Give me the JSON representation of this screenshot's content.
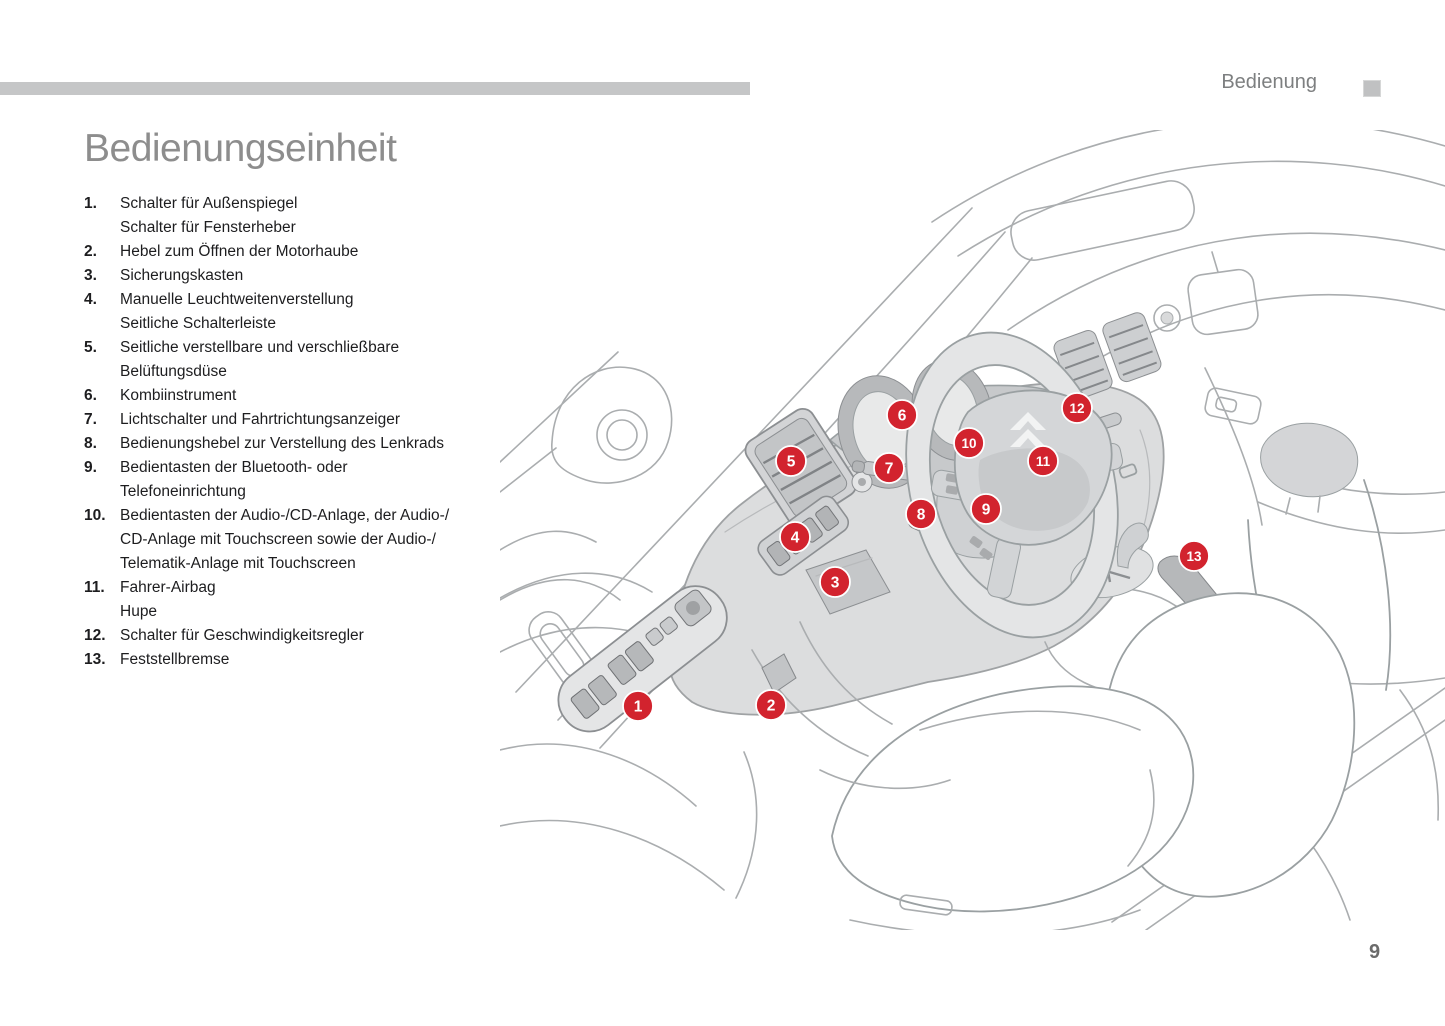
{
  "header": {
    "section_label": "Bedienung"
  },
  "title": "Bedienungseinheit",
  "footer": {
    "page_number": "9"
  },
  "legend": [
    {
      "num": "1.",
      "lines": [
        "Schalter für Außenspiegel",
        "Schalter für Fensterheber"
      ]
    },
    {
      "num": "2.",
      "lines": [
        "Hebel zum Öffnen der Motorhaube"
      ]
    },
    {
      "num": "3.",
      "lines": [
        "Sicherungskasten"
      ]
    },
    {
      "num": "4.",
      "lines": [
        "Manuelle Leuchtweitenverstellung",
        "Seitliche Schalterleiste"
      ]
    },
    {
      "num": "5.",
      "lines": [
        "Seitliche verstellbare und verschließbare",
        "Belüftungsdüse"
      ]
    },
    {
      "num": "6.",
      "lines": [
        "Kombiinstrument"
      ]
    },
    {
      "num": "7.",
      "lines": [
        "Lichtschalter und Fahrtrichtungsanzeiger"
      ]
    },
    {
      "num": "8.",
      "lines": [
        "Bedienungshebel zur Verstellung des Lenkrads"
      ]
    },
    {
      "num": "9.",
      "lines": [
        "Bedientasten der Bluetooth- oder",
        "Telefoneinrichtung"
      ]
    },
    {
      "num": "10.",
      "lines": [
        "Bedientasten der Audio-/CD-Anlage, der Audio-/",
        "CD-Anlage mit Touchscreen sowie der Audio-/",
        "Telematik-Anlage mit Touchscreen"
      ]
    },
    {
      "num": "11.",
      "lines": [
        "Fahrer-Airbag",
        "Hupe"
      ]
    },
    {
      "num": "12.",
      "lines": [
        "Schalter für Geschwindigkeitsregler"
      ]
    },
    {
      "num": "13.",
      "lines": [
        "Feststellbremse"
      ]
    }
  ],
  "diagram": {
    "marker_color": "#d2232e",
    "markers": [
      {
        "label": "1",
        "x": 138,
        "y": 576
      },
      {
        "label": "2",
        "x": 271,
        "y": 575
      },
      {
        "label": "3",
        "x": 335,
        "y": 452
      },
      {
        "label": "4",
        "x": 295,
        "y": 407
      },
      {
        "label": "5",
        "x": 291,
        "y": 331
      },
      {
        "label": "6",
        "x": 402,
        "y": 285
      },
      {
        "label": "7",
        "x": 389,
        "y": 338
      },
      {
        "label": "8",
        "x": 421,
        "y": 384
      },
      {
        "label": "9",
        "x": 486,
        "y": 379
      },
      {
        "label": "10",
        "x": 469,
        "y": 313
      },
      {
        "label": "11",
        "x": 543,
        "y": 331
      },
      {
        "label": "12",
        "x": 577,
        "y": 278
      },
      {
        "label": "13",
        "x": 694,
        "y": 426
      }
    ]
  },
  "colors": {
    "marker_red": "#d2232e",
    "top_bar_gray": "#c5c6c7",
    "title_gray": "#8d8d8d",
    "header_gray": "#7d7f80",
    "body_text": "#1d1d1f",
    "line_gray": "#aaadaf",
    "dash_fill": "#dcddde"
  }
}
